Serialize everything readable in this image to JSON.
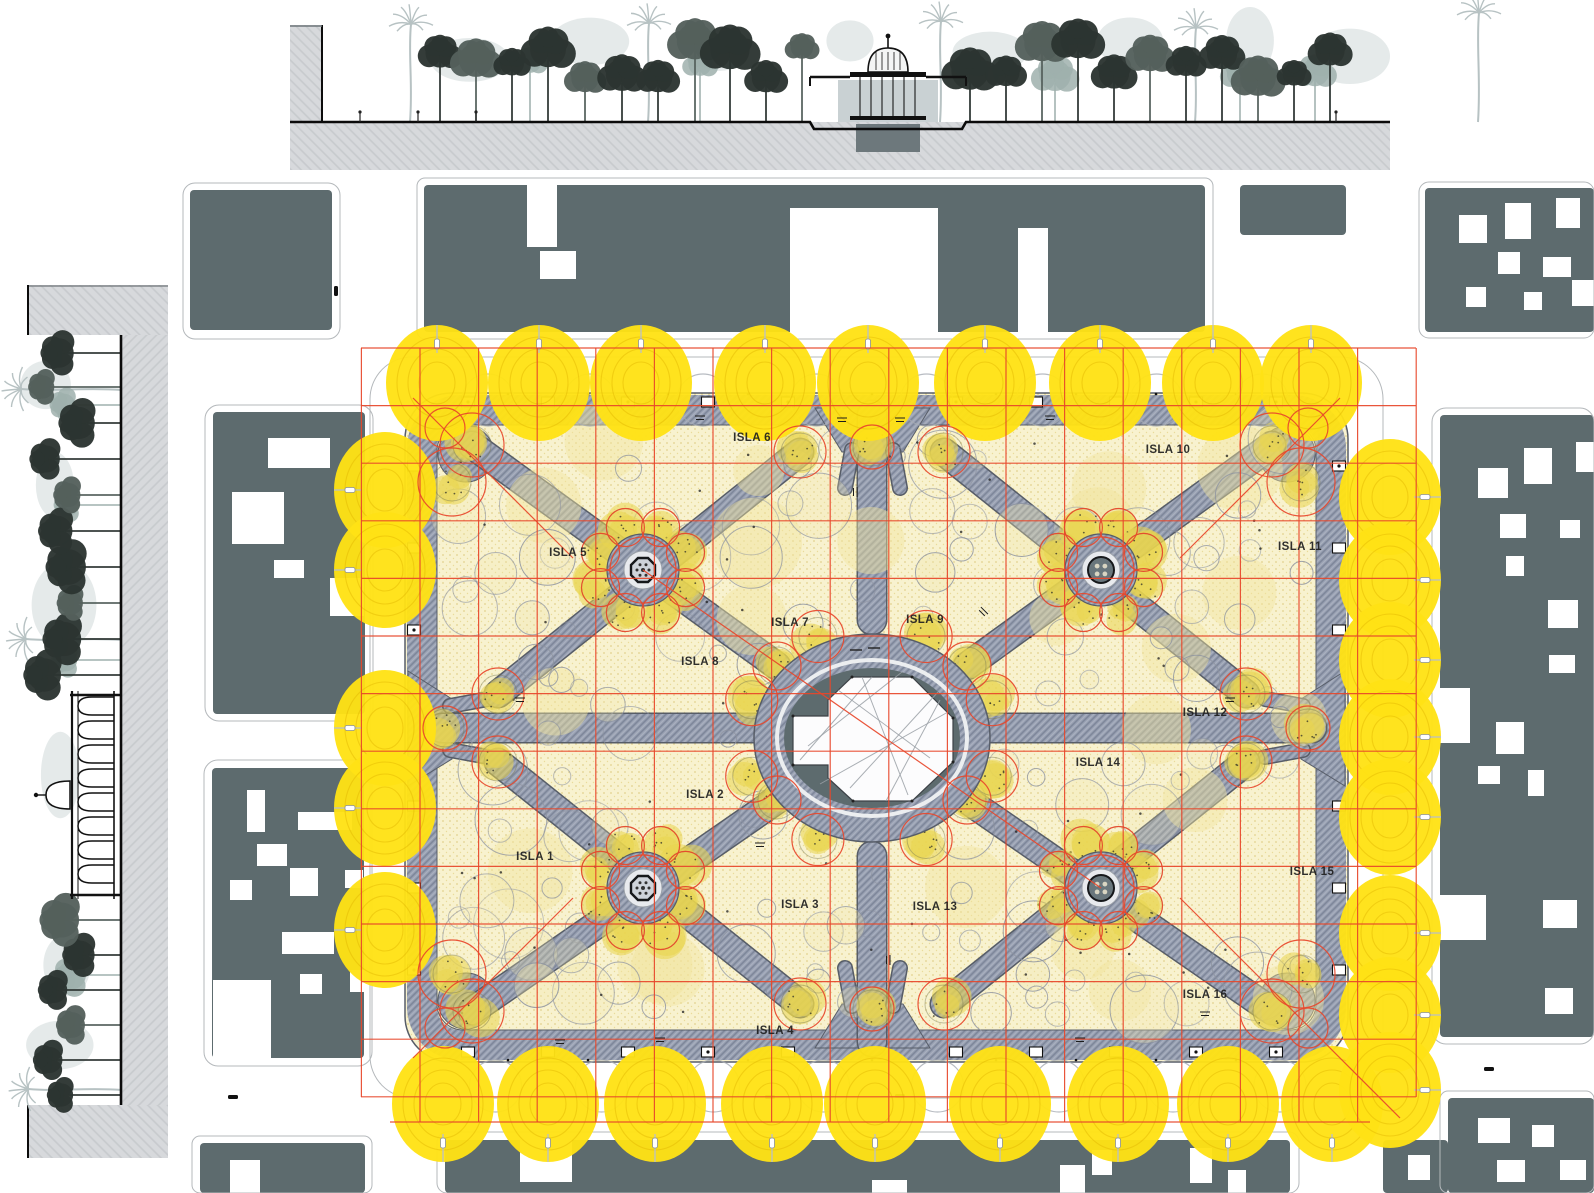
{
  "islas": [
    "ISLA 1",
    "ISLA 2",
    "ISLA 3",
    "ISLA 4",
    "ISLA 5",
    "ISLA 6",
    "ISLA 7",
    "ISLA 8",
    "ISLA 9",
    "ISLA 10",
    "ISLA 11",
    "ISLA 12",
    "ISLA 13",
    "ISLA 14",
    "ISLA 15",
    "ISLA 16"
  ],
  "colors": {
    "building": "#5d6b6e",
    "section_ground": "#d7d9dc",
    "section_hatch": "#c7cacd",
    "plaza_ground": "#f8f2cf",
    "plaza_dot": "#dcc97e",
    "path_gray": "#9aa2b4",
    "path_hatch": "#7d8699",
    "path_edge": "#575d68",
    "ellipse_dark": "#5d6b6e",
    "tree_yellow": "#ffe215",
    "tree_ring": "#e0b400",
    "cluster_yellow": "#ead54e",
    "grid_red": "#e8472b",
    "canopy_gray": "#8d93a0",
    "ink": "#1a1a1a",
    "tree_dark": "#2c3431",
    "tree_light": "#9fb0ad",
    "palm_gray": "#b7c2c3",
    "haze": "#d7dede"
  }
}
